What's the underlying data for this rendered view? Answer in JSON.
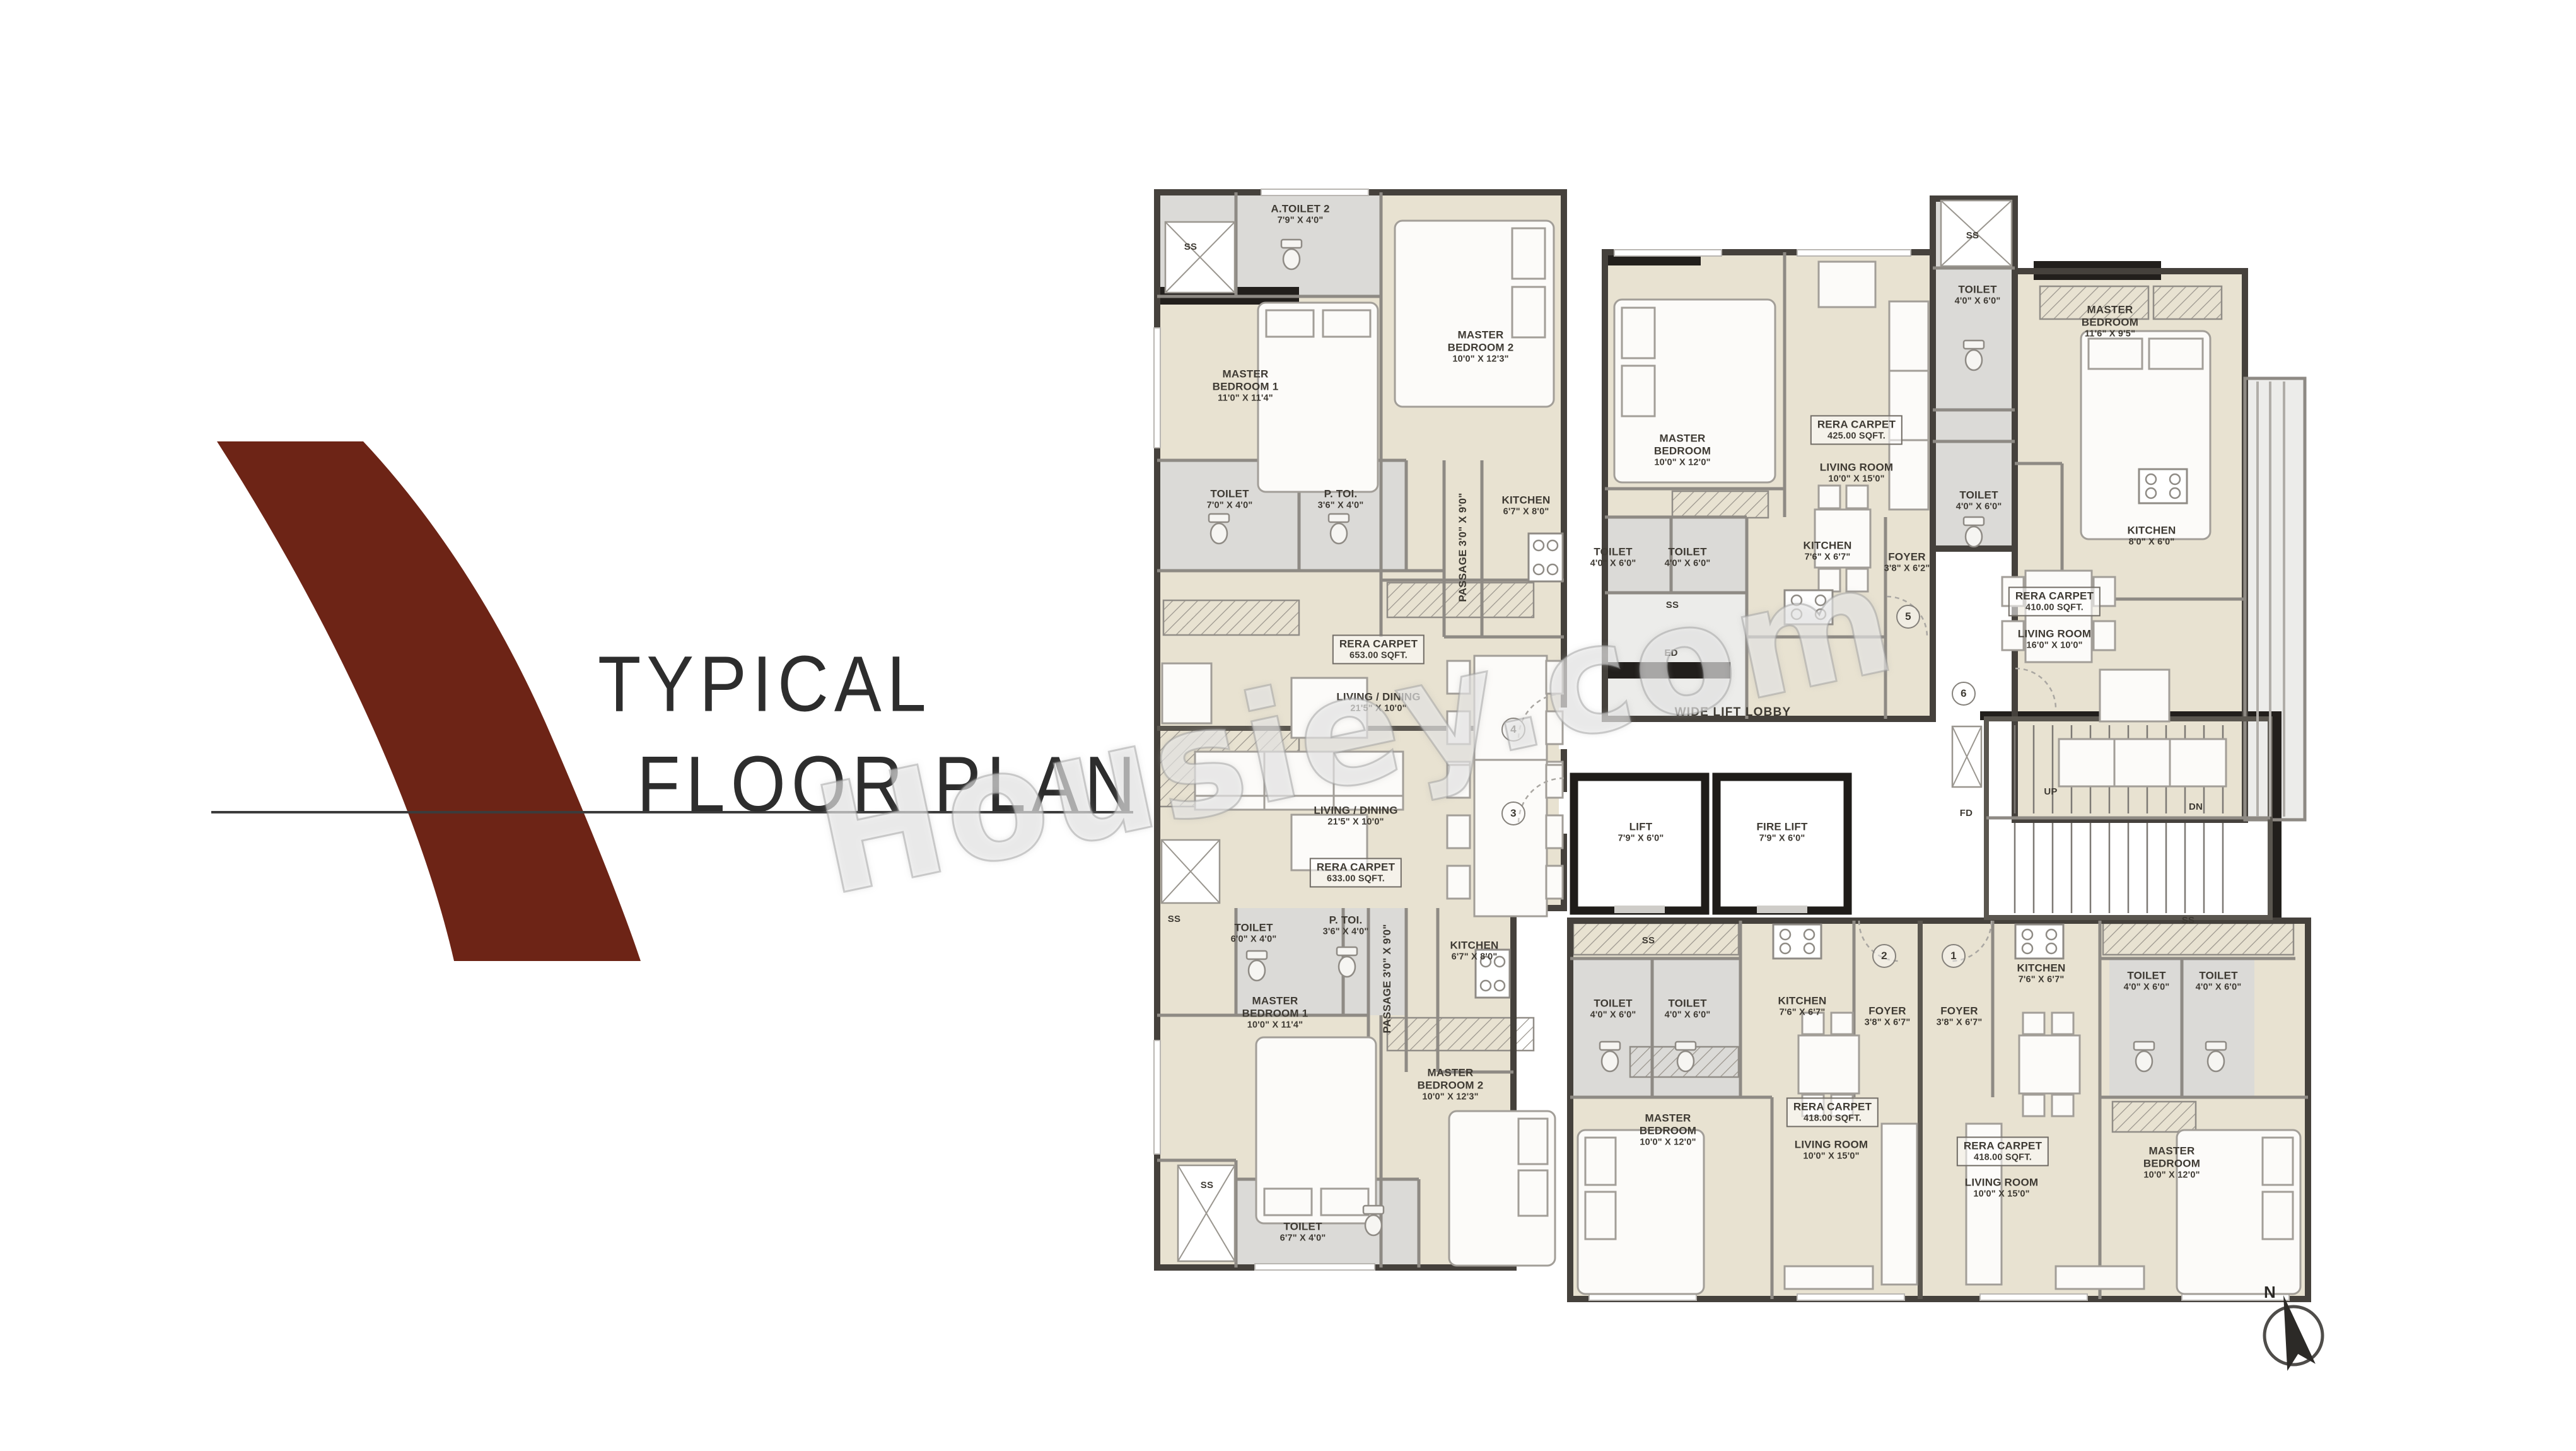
{
  "title": {
    "line1": "TYPICAL",
    "line2": "FLOOR PLAN"
  },
  "watermark": "Housiey.com",
  "compass": {
    "label": "N"
  },
  "colors": {
    "logo": "#6d2416",
    "wall": "#45413c",
    "room_beige": "#e8e2d1",
    "room_gray": "#dbdad7",
    "text": "#3e3a33"
  },
  "plan": {
    "labels": [
      {
        "id": "u4-ss",
        "kind": "tag",
        "lines": [
          "SS"
        ]
      },
      {
        "id": "u4-atoilet2",
        "kind": "room",
        "lines": [
          "A.TOILET 2",
          "7'9\" X 4'0\""
        ]
      },
      {
        "id": "u4-mb1",
        "kind": "room",
        "lines": [
          "MASTER",
          "BEDROOM 1",
          "11'0\" X 11'4\""
        ]
      },
      {
        "id": "u4-mb2",
        "kind": "room",
        "lines": [
          "MASTER",
          "BEDROOM 2",
          "10'0\" X 12'3\""
        ]
      },
      {
        "id": "u4-toilet",
        "kind": "room",
        "lines": [
          "TOILET",
          "7'0\" X 4'0\""
        ]
      },
      {
        "id": "u4-ptoi",
        "kind": "room",
        "lines": [
          "P. TOI.",
          "3'6\" X 4'0\""
        ]
      },
      {
        "id": "u4-passage",
        "kind": "rot",
        "lines": [
          "PASSAGE  3'0\" X 9'0\""
        ]
      },
      {
        "id": "u4-kitchen",
        "kind": "room",
        "lines": [
          "KITCHEN",
          "6'7\" X 8'0\""
        ]
      },
      {
        "id": "u4-rera",
        "kind": "rera",
        "lines": [
          "RERA CARPET",
          "653.00 SQFT."
        ]
      },
      {
        "id": "u4-livdin",
        "kind": "room",
        "lines": [
          "LIVING / DINING",
          "21'5\" X 10'0\""
        ]
      },
      {
        "id": "c4",
        "kind": "circle",
        "lines": [
          "4"
        ]
      },
      {
        "id": "c3",
        "kind": "circle",
        "lines": [
          "3"
        ]
      },
      {
        "id": "u3-livdin",
        "kind": "room",
        "lines": [
          "LIVING / DINING",
          "21'5\" X 10'0\""
        ]
      },
      {
        "id": "u3-rera",
        "kind": "rera",
        "lines": [
          "RERA CARPET",
          "633.00 SQFT."
        ]
      },
      {
        "id": "u3-ss-left",
        "kind": "tag",
        "lines": [
          "SS"
        ]
      },
      {
        "id": "u3-toilet",
        "kind": "room",
        "lines": [
          "TOILET",
          "6'0\" X 4'0\""
        ]
      },
      {
        "id": "u3-ptoi",
        "kind": "room",
        "lines": [
          "P. TOI.",
          "3'6\" X 4'0\""
        ]
      },
      {
        "id": "u3-passage",
        "kind": "rot",
        "lines": [
          "PASSAGE  3'0\" X 9'0\""
        ]
      },
      {
        "id": "u3-kitchen",
        "kind": "room",
        "lines": [
          "KITCHEN",
          "6'7\" X 8'0\""
        ]
      },
      {
        "id": "u3-mb1",
        "kind": "room",
        "lines": [
          "MASTER",
          "BEDROOM 1",
          "10'0\" X 11'4\""
        ]
      },
      {
        "id": "u3-mb2",
        "kind": "room",
        "lines": [
          "MASTER",
          "BEDROOM 2",
          "10'0\" X 12'3\""
        ]
      },
      {
        "id": "u3-toilet2",
        "kind": "room",
        "lines": [
          "TOILET",
          "6'7\" X 4'0\""
        ]
      },
      {
        "id": "u3-ss-bottom",
        "kind": "tag",
        "lines": [
          "SS"
        ]
      },
      {
        "id": "u5-mb",
        "kind": "room",
        "lines": [
          "MASTER",
          "BEDROOM",
          "10'0\" X 12'0\""
        ]
      },
      {
        "id": "u5-rera",
        "kind": "rera",
        "lines": [
          "RERA CARPET",
          "425.00 SQFT."
        ]
      },
      {
        "id": "u5-living",
        "kind": "room",
        "lines": [
          "LIVING ROOM",
          "10'0\" X 15'0\""
        ]
      },
      {
        "id": "u5-toilet-a",
        "kind": "room",
        "lines": [
          "TOILET",
          "4'0\" X 6'0\""
        ]
      },
      {
        "id": "u5-toilet-b",
        "kind": "room",
        "lines": [
          "TOILET",
          "4'0\" X 6'0\""
        ]
      },
      {
        "id": "u5-kitchen",
        "kind": "room",
        "lines": [
          "KITCHEN",
          "7'6\" X 6'7\""
        ]
      },
      {
        "id": "u5-foyer",
        "kind": "room",
        "lines": [
          "FOYER",
          "3'8\" X 6'2\""
        ]
      },
      {
        "id": "u5-ss",
        "kind": "tag",
        "lines": [
          "SS"
        ]
      },
      {
        "id": "u5-ed",
        "kind": "tag",
        "lines": [
          "ED"
        ]
      },
      {
        "id": "c5",
        "kind": "circle",
        "lines": [
          "5"
        ]
      },
      {
        "id": "svc-ss",
        "kind": "tag",
        "lines": [
          "SS"
        ]
      },
      {
        "id": "svc-toilet-a",
        "kind": "room",
        "lines": [
          "TOILET",
          "4'0\" X 6'0\""
        ]
      },
      {
        "id": "svc-toilet-b",
        "kind": "room",
        "lines": [
          "TOILET",
          "4'0\" X 6'0\""
        ]
      },
      {
        "id": "u6-mb",
        "kind": "room",
        "lines": [
          "MASTER",
          "BEDROOM",
          "11'6\" X 9'5\""
        ]
      },
      {
        "id": "u6-kitchen",
        "kind": "room",
        "lines": [
          "KITCHEN",
          "8'0\" X 6'0\""
        ]
      },
      {
        "id": "u6-rera",
        "kind": "rera",
        "lines": [
          "RERA CARPET",
          "410.00 SQFT."
        ]
      },
      {
        "id": "u6-living",
        "kind": "room",
        "lines": [
          "LIVING ROOM",
          "16'0\" X 10'0\""
        ]
      },
      {
        "id": "c6",
        "kind": "circle",
        "lines": [
          "6"
        ]
      },
      {
        "id": "lobby",
        "kind": "big",
        "lines": [
          "WIDE LIFT LOBBY"
        ]
      },
      {
        "id": "lift",
        "kind": "room",
        "lines": [
          "LIFT",
          "7'9\" X 6'0\""
        ]
      },
      {
        "id": "fire-lift",
        "kind": "room",
        "lines": [
          "FIRE LIFT",
          "7'9\" X 6'0\""
        ]
      },
      {
        "id": "fd",
        "kind": "tag",
        "lines": [
          "FD"
        ]
      },
      {
        "id": "up",
        "kind": "tag",
        "lines": [
          "UP"
        ]
      },
      {
        "id": "dn",
        "kind": "tag",
        "lines": [
          "DN"
        ]
      },
      {
        "id": "u2-ss",
        "kind": "tag",
        "lines": [
          "SS"
        ]
      },
      {
        "id": "u2-toilet-a",
        "kind": "room",
        "lines": [
          "TOILET",
          "4'0\" X 6'0\""
        ]
      },
      {
        "id": "u2-toilet-b",
        "kind": "room",
        "lines": [
          "TOILET",
          "4'0\" X 6'0\""
        ]
      },
      {
        "id": "u2-kitchen",
        "kind": "room",
        "lines": [
          "KITCHEN",
          "7'6\" X 6'7\""
        ]
      },
      {
        "id": "u2-foyer",
        "kind": "room",
        "lines": [
          "FOYER",
          "3'8\" X 6'7\""
        ]
      },
      {
        "id": "c2",
        "kind": "circle",
        "lines": [
          "2"
        ]
      },
      {
        "id": "u2-mb",
        "kind": "room",
        "lines": [
          "MASTER",
          "BEDROOM",
          "10'0\" X 12'0\""
        ]
      },
      {
        "id": "u2-rera",
        "kind": "rera",
        "lines": [
          "RERA CARPET",
          "418.00 SQFT."
        ]
      },
      {
        "id": "u2-living",
        "kind": "room",
        "lines": [
          "LIVING ROOM",
          "10'0\" X 15'0\""
        ]
      },
      {
        "id": "u1-foyer",
        "kind": "room",
        "lines": [
          "FOYER",
          "3'8\" X 6'7\""
        ]
      },
      {
        "id": "c1",
        "kind": "circle",
        "lines": [
          "1"
        ]
      },
      {
        "id": "u1-kitchen",
        "kind": "room",
        "lines": [
          "KITCHEN",
          "7'6\" X 6'7\""
        ]
      },
      {
        "id": "u1-ss",
        "kind": "tag",
        "lines": [
          "SS"
        ]
      },
      {
        "id": "u1-toilet-a",
        "kind": "room",
        "lines": [
          "TOILET",
          "4'0\" X 6'0\""
        ]
      },
      {
        "id": "u1-toilet-b",
        "kind": "room",
        "lines": [
          "TOILET",
          "4'0\" X 6'0\""
        ]
      },
      {
        "id": "u1-rera",
        "kind": "rera",
        "lines": [
          "RERA CARPET",
          "418.00 SQFT."
        ]
      },
      {
        "id": "u1-living",
        "kind": "room",
        "lines": [
          "LIVING ROOM",
          "10'0\" X 15'0\""
        ]
      },
      {
        "id": "u1-mb",
        "kind": "room",
        "lines": [
          "MASTER",
          "BEDROOM",
          "10'0\" X 12'0\""
        ]
      }
    ]
  }
}
